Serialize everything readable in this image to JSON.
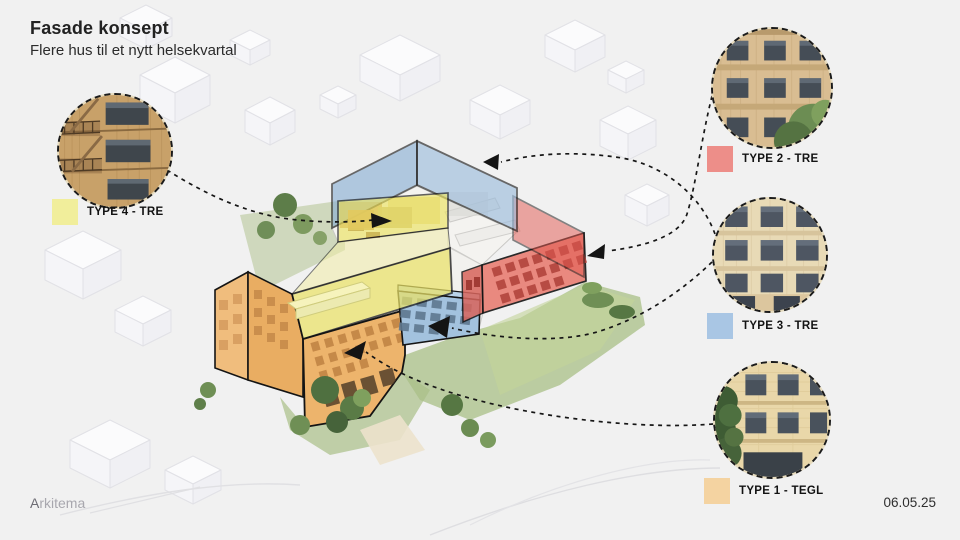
{
  "slide": {
    "title": "Fasade konsept",
    "subtitle": "Flere hus til et nytt helsekvartal",
    "logo": "Arkitema",
    "date": "06.05.25"
  },
  "legend": {
    "items": [
      {
        "id": "type-4",
        "label": "TYPE 4 - TRE",
        "color": "#f1ee9b"
      },
      {
        "id": "type-2",
        "label": "TYPE 2 - TRE",
        "color": "#ed8e89"
      },
      {
        "id": "type-3",
        "label": "TYPE 3 - TRE",
        "color": "#a9c6e4"
      },
      {
        "id": "type-1",
        "label": "TYPE 1 - TEGL",
        "color": "#f4d3a1"
      }
    ]
  },
  "diagram": {
    "volume_colors": {
      "yellow": "#ebe368",
      "red": "#e2584f",
      "blue": "#8fb4d8",
      "orange": "#edb46c"
    }
  }
}
